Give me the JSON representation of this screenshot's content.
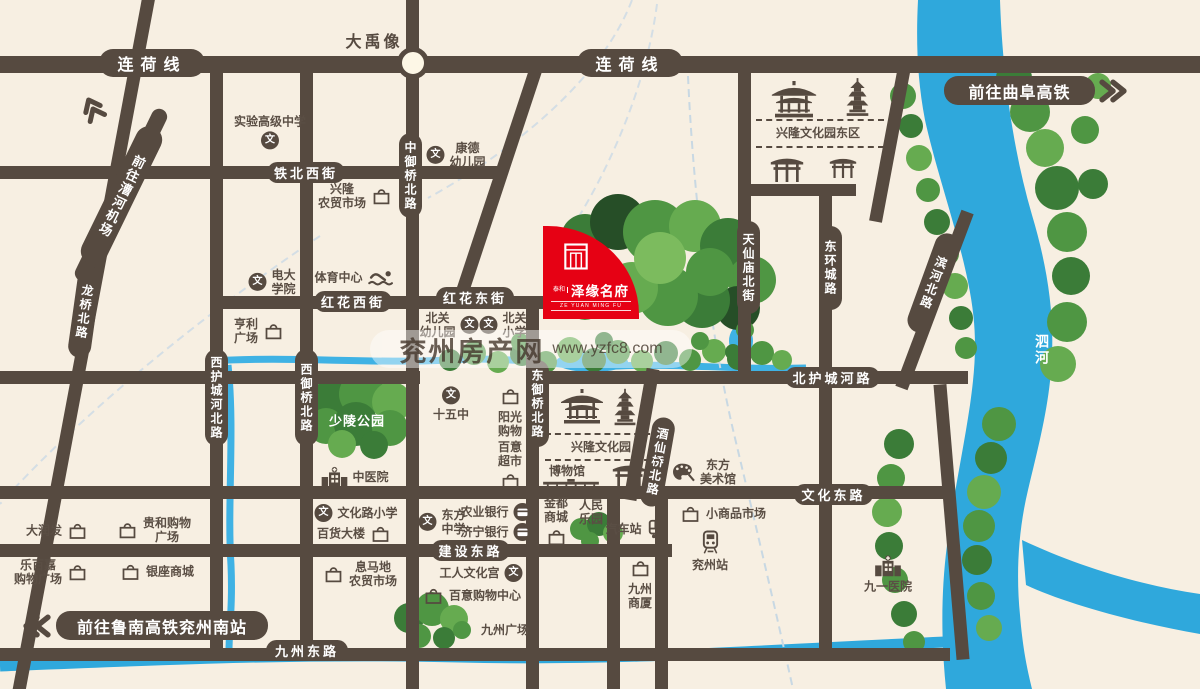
{
  "colors": {
    "background": "#f7efe2",
    "road": "#564a40",
    "river": "#2fa8dc",
    "accent_red": "#e60114",
    "watermark_blue": "#7fa9d8",
    "watermark_red": "#dd6f6b"
  },
  "roads": {
    "lianhe": "连荷线",
    "tiebei": "铁北西街",
    "honghua_w": "红花西街",
    "honghua_e": "红花东街",
    "beihucheng": "北护城河路",
    "jianshe": "建设东路",
    "wenhua_e": "文化东路",
    "jiuzhou_e": "九州东路",
    "zhongyuqiao": "中御桥北路",
    "longqiao": "龙桥北路",
    "xihucheng": "西护城河北路",
    "xiyuqiao": "西御桥北路",
    "dongyuqiao": "东御桥北路",
    "tianxianmiao": "天仙庙北街",
    "donghuancheng": "东环城路",
    "jiuxianqiao": "酒仙桥北路",
    "binhe": "滨河北路"
  },
  "signs": {
    "qufu": "前往曲阜高铁",
    "lunan": "前往鲁南高铁兖州南站",
    "airport": "前往漕河机场"
  },
  "areas": {
    "dayu": "大禹像",
    "xl_east": "兴隆文化园东区",
    "xl_park": "兴隆文化园",
    "bowuguan": "博物馆",
    "shaoling": "少陵公园",
    "jiuzhou_plaza": "九州广场",
    "sihe": "泗河"
  },
  "lm": {
    "shiyan": "实验高级中学",
    "kangde": "康德\n幼儿园",
    "xinglong_market": "兴隆\n农贸市场",
    "dianda": "电大\n学院",
    "tiyu": "体育中心",
    "hengli": "亨利\n广场",
    "beiguan_kg": "北关\n幼儿园",
    "beiguan_xx": "北关\n小学",
    "shiwuzhong": "十五中",
    "yangguang": "阳光\n购物",
    "baiyi_super": "百意\n超市",
    "zhongyiyuan": "中医院",
    "wenhualu_xx": "文化路小学",
    "baihuo": "百货大楼",
    "dongfang_zx": "东方\n中学",
    "nongye_bank": "农业银行",
    "jining_bank": "济宁银行",
    "jindu": "金都\n商城",
    "renmin": "人民\n乐园",
    "qiche": "汽车站",
    "ximadi": "息马地\n农贸市场",
    "gongren": "工人文化宫",
    "baiyi_mall": "百意购物中心",
    "darunfa": "大润发",
    "guihe": "贵和购物\n广场",
    "lebaijia": "乐百嘉\n购物广场",
    "yinzuo": "银座商城",
    "jiuzhou_sx": "九州\n商厦",
    "xiaoshangpin": "小商品市场",
    "yanzhou_stn": "兖州站",
    "dongfang_art": "东方\n美术馆",
    "jiuyi": "九一医院"
  },
  "project": {
    "prefix": "泰和",
    "name": "泽缘名府",
    "english": "ZE YUAN MING FU"
  },
  "watermark": {
    "site": "兖州房产网",
    "url": "www.yzfc8.com"
  }
}
